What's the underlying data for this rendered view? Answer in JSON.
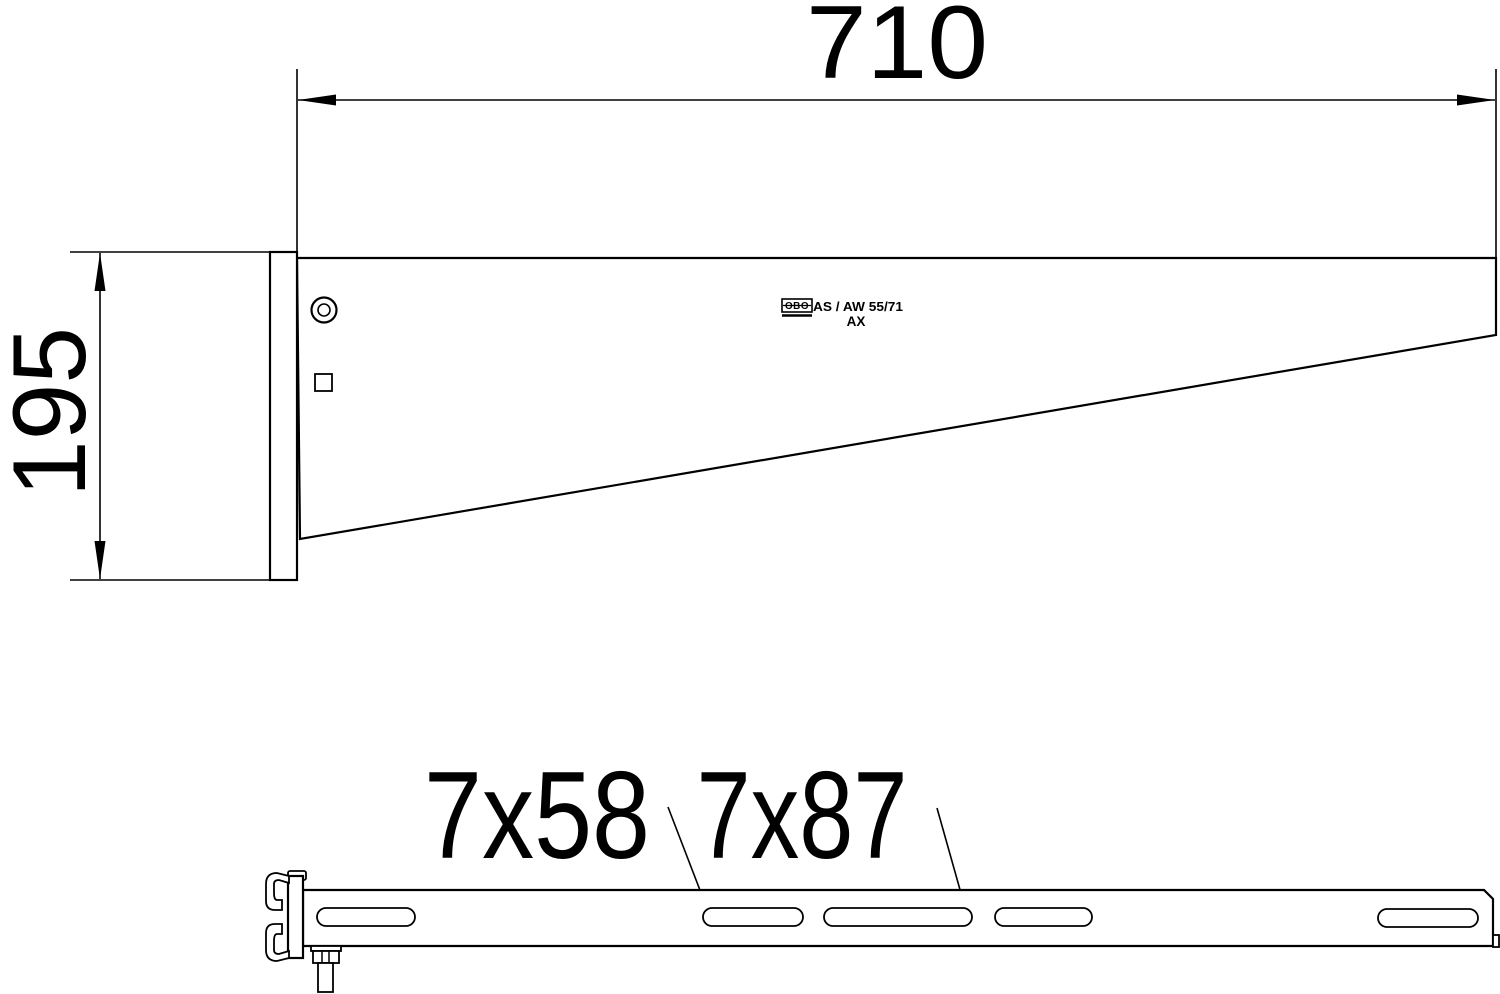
{
  "colors": {
    "line": "#000000",
    "background": "#ffffff"
  },
  "side_view": {
    "width_dimension": "710",
    "height_dimension": "195",
    "marking": {
      "logo": "OBO",
      "line1": "AS / AW 55/71",
      "line2": "AX"
    }
  },
  "bottom_view": {
    "slot_label_left": "7x58",
    "slot_label_right": "7x87"
  }
}
